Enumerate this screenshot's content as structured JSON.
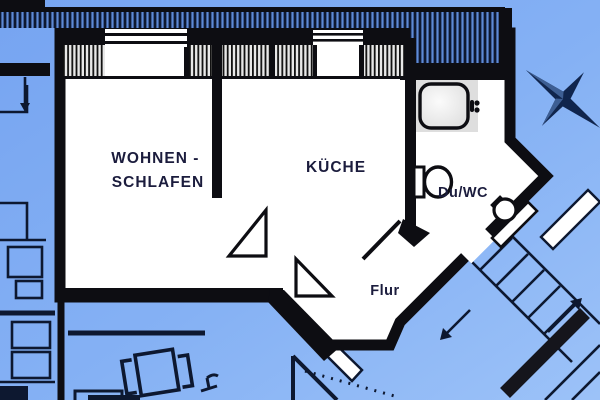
{
  "plan": {
    "title": "apartment-floor-plan",
    "rooms": {
      "living_line1": "WOHNEN -",
      "living_line2": "SCHLAFEN",
      "kitchen": "KÜCHE",
      "bath": "Du/WC",
      "hall": "Flur"
    },
    "fixtures": [
      "shower-tray",
      "toilet",
      "wash-basin",
      "balcony-railing",
      "windows",
      "stairs",
      "table-and-chairs"
    ],
    "icons": {
      "compass": "compass-star-icon"
    }
  },
  "colors": {
    "background_top": "#76a4f1",
    "background_bottom": "#9cc2f8",
    "wall": "#0d0d12",
    "room_fill": "#ffffff",
    "label": "#1b1c3d",
    "railing_dark": "#0e1830",
    "railing_blue": "#5e8ad6",
    "neighbor_line": "#0d1830",
    "shower_block": "#dedede",
    "shower_tray": "#f2f2f2",
    "star": "#10254d"
  }
}
